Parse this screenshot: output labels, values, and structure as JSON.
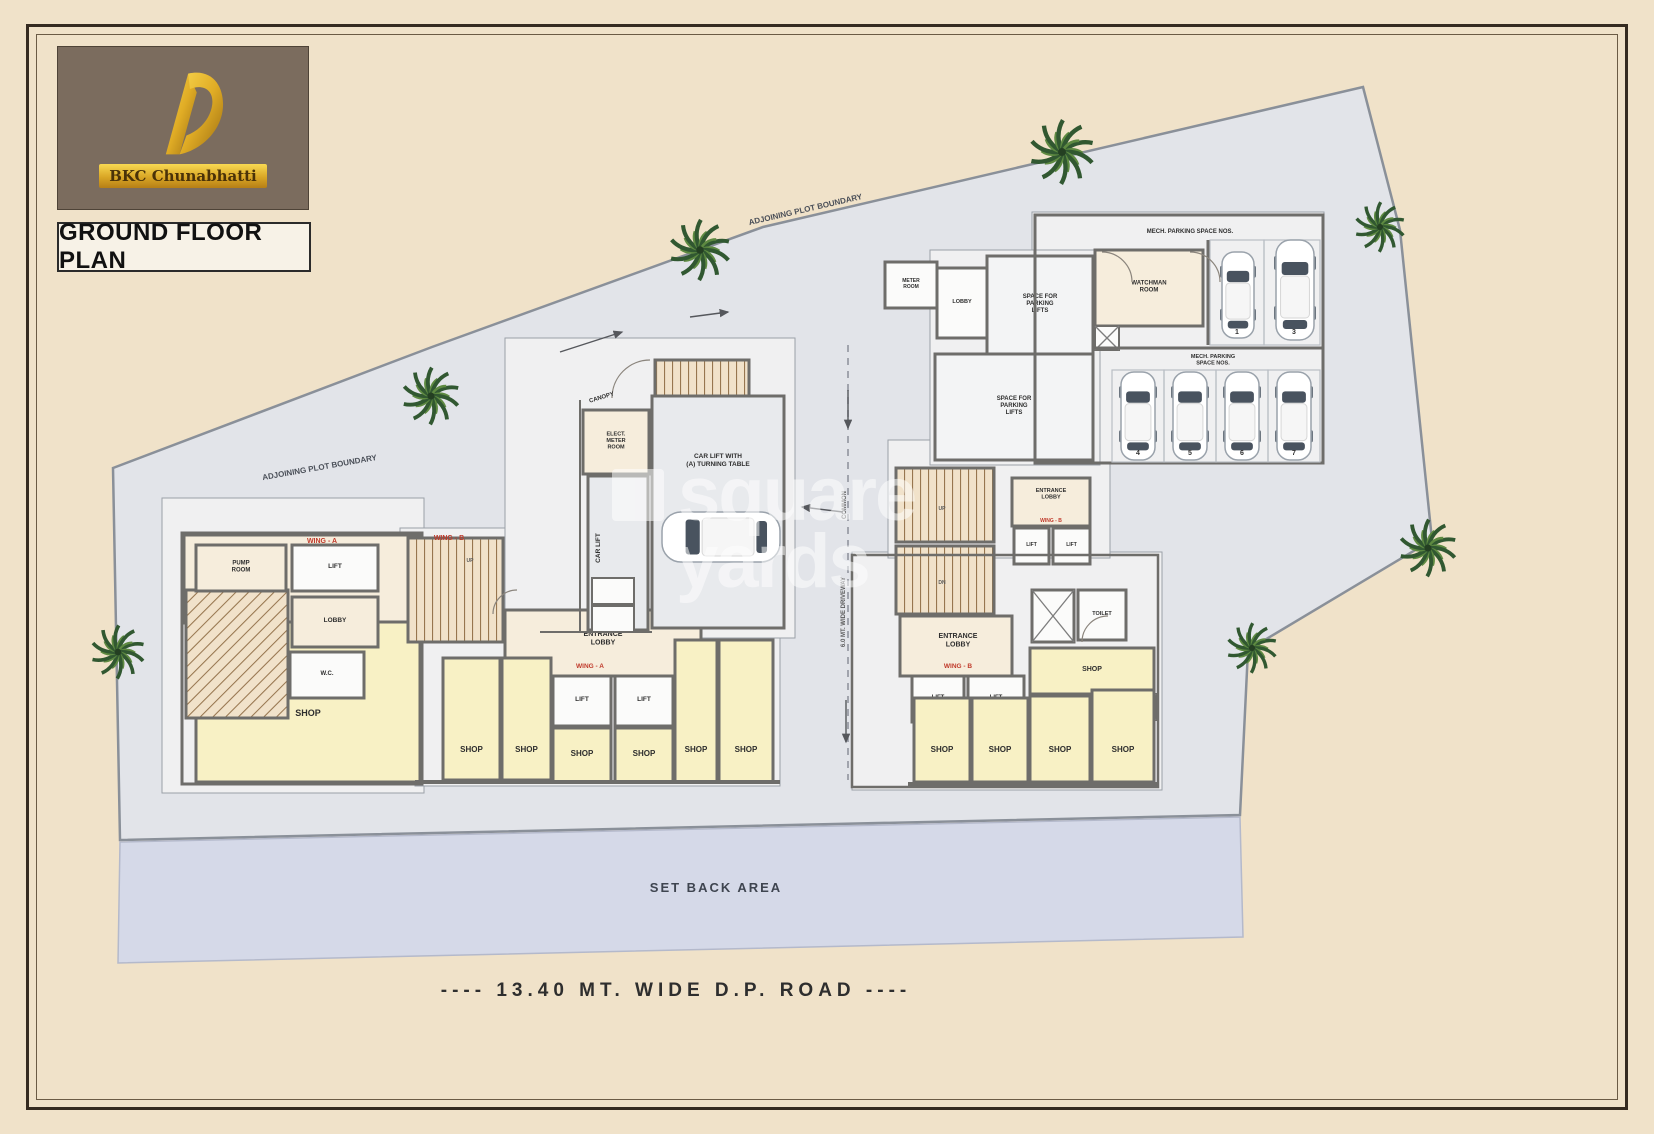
{
  "branding": {
    "logo_text": "BKC Chunabhatti",
    "title": "GROUND FLOOR PLAN"
  },
  "watermark": {
    "line1": "square",
    "line2": "yards"
  },
  "colors": {
    "page": "#f0e2c9",
    "plot": "#e2e4e9",
    "plotline": "#8a9099",
    "setback": "#d5d9e8",
    "setline": "#b4b9cb",
    "wall": "#6e6d6a",
    "cream": "#f6eddc",
    "white": "#fbfbfa",
    "yellow": "#f8f1c5",
    "gray": "#e8eaed",
    "slab": "#f0f0f1",
    "slabw": "#f3f4f5",
    "stair": "#f1e2ca",
    "stairline": "#97764f",
    "red": "#c03a2b",
    "ink": "#2e2e2e",
    "mut": "#5a5a5a",
    "mut2": "#4a4f58",
    "set": "#3f4550",
    "bay": "#b9bdc4",
    "carline": "#9aa2ab",
    "dark": "#49535f",
    "green1": "#315831",
    "green2": "#5e8a41"
  },
  "plan": {
    "plot_points": "113,468 432,347 763,227 1363,87 1400,230 1432,540 1248,650 1240,815 120,840",
    "setback_points": "120,842 1240,817 1243,937 118,963",
    "slabs": [
      {
        "id": "apron-left-wing",
        "x": 162,
        "y": 498,
        "w": 262,
        "h": 295
      },
      {
        "id": "apron-center-stair",
        "x": 400,
        "y": 528,
        "w": 110,
        "h": 120
      },
      {
        "id": "apron-shops-row",
        "x": 415,
        "y": 628,
        "w": 365,
        "h": 158
      },
      {
        "id": "apron-core",
        "x": 505,
        "y": 338,
        "w": 290,
        "h": 300
      },
      {
        "id": "apron-right-wing",
        "x": 852,
        "y": 552,
        "w": 310,
        "h": 238
      },
      {
        "id": "apron-right-wing-upper",
        "x": 888,
        "y": 440,
        "w": 222,
        "h": 118
      },
      {
        "id": "apron-parking",
        "x": 1032,
        "y": 212,
        "w": 292,
        "h": 252
      },
      {
        "id": "apron-parking-lifts",
        "x": 930,
        "y": 250,
        "w": 170,
        "h": 215
      }
    ],
    "rooms": [
      {
        "id": "left-wing-base",
        "x": 184,
        "y": 535,
        "w": 236,
        "h": 88,
        "f": "cream"
      },
      {
        "id": "left-wing-shop",
        "x": 196,
        "y": 622,
        "w": 224,
        "h": 160,
        "f": "yellow",
        "label": [
          "SHOP"
        ],
        "fs": 9,
        "ly": 716
      },
      {
        "id": "left-wing-winding-stair",
        "x": 186,
        "y": 590,
        "w": 102,
        "h": 128,
        "p": "d"
      },
      {
        "id": "left-wing-pump-room",
        "x": 196,
        "y": 545,
        "w": 90,
        "h": 46,
        "f": "cream",
        "label": [
          "PUMP",
          "ROOM"
        ],
        "fs": 6
      },
      {
        "id": "left-wing-lift",
        "x": 292,
        "y": 545,
        "w": 86,
        "h": 46,
        "f": "white",
        "label": [
          "LIFT"
        ],
        "fs": 6.5
      },
      {
        "id": "left-wing-lobby",
        "x": 292,
        "y": 597,
        "w": 86,
        "h": 50,
        "f": "cream",
        "label": [
          "LOBBY"
        ],
        "fs": 6.5
      },
      {
        "id": "left-wing-wc",
        "x": 290,
        "y": 652,
        "w": 74,
        "h": 46,
        "f": "white",
        "label": [
          "W.C."
        ],
        "fs": 6
      },
      {
        "id": "left-wing-outline",
        "x": 182,
        "y": 533,
        "w": 240,
        "h": 251,
        "f": "none",
        "sw": 3
      },
      {
        "id": "center-stair",
        "x": 408,
        "y": 538,
        "w": 95,
        "h": 104,
        "p": "v"
      },
      {
        "id": "center-entrance-lobby",
        "x": 505,
        "y": 610,
        "w": 196,
        "h": 66,
        "f": "cream",
        "label": [
          "ENTRANCE",
          "LOBBY"
        ],
        "fs": 7,
        "ly": 636
      },
      {
        "id": "center-lift-1",
        "x": 553,
        "y": 676,
        "w": 58,
        "h": 50,
        "f": "white",
        "label": [
          "LIFT"
        ],
        "fs": 6.5
      },
      {
        "id": "center-lift-2",
        "x": 615,
        "y": 676,
        "w": 58,
        "h": 50,
        "f": "white",
        "label": [
          "LIFT"
        ],
        "fs": 6.5
      },
      {
        "id": "shop-1",
        "x": 443,
        "y": 658,
        "w": 57,
        "h": 122,
        "f": "yellow",
        "label": [
          "SHOP"
        ],
        "fs": 8,
        "ly": 752
      },
      {
        "id": "shop-2",
        "x": 502,
        "y": 658,
        "w": 49,
        "h": 122,
        "f": "yellow",
        "label": [
          "SHOP"
        ],
        "fs": 8,
        "ly": 752
      },
      {
        "id": "shop-3",
        "x": 553,
        "y": 728,
        "w": 58,
        "h": 54,
        "f": "yellow",
        "label": [
          "SHOP"
        ],
        "fs": 8,
        "ly": 756
      },
      {
        "id": "shop-4",
        "x": 615,
        "y": 728,
        "w": 58,
        "h": 54,
        "f": "yellow",
        "label": [
          "SHOP"
        ],
        "fs": 8,
        "ly": 756
      },
      {
        "id": "shop-5",
        "x": 675,
        "y": 640,
        "w": 42,
        "h": 142,
        "f": "yellow",
        "label": [
          "SHOP"
        ],
        "fs": 8,
        "ly": 752
      },
      {
        "id": "shop-6",
        "x": 719,
        "y": 640,
        "w": 54,
        "h": 142,
        "f": "yellow",
        "label": [
          "SHOP"
        ],
        "fs": 8,
        "ly": 752
      },
      {
        "id": "core-meter-room",
        "x": 583,
        "y": 410,
        "w": 66,
        "h": 64,
        "f": "cream",
        "label": [
          "ELECT.",
          "METER",
          "ROOM"
        ],
        "fs": 5.5
      },
      {
        "id": "core-stair",
        "x": 655,
        "y": 360,
        "w": 94,
        "h": 38,
        "p": "v"
      },
      {
        "id": "core-car-lift-shaft",
        "x": 588,
        "y": 476,
        "w": 60,
        "h": 154,
        "f": "gray"
      },
      {
        "id": "core-box-1",
        "x": 592,
        "y": 578,
        "w": 42,
        "h": 26,
        "f": "white",
        "sw": 2
      },
      {
        "id": "core-box-2",
        "x": 592,
        "y": 606,
        "w": 42,
        "h": 26,
        "f": "white",
        "sw": 2
      },
      {
        "id": "core-turntable-room",
        "x": 652,
        "y": 396,
        "w": 132,
        "h": 232,
        "f": "gray",
        "label": [
          "CAR LIFT WITH",
          "(A) TURNING TABLE"
        ],
        "fs": 6.5,
        "ly": 458
      },
      {
        "id": "right-wing-stair-1",
        "x": 896,
        "y": 468,
        "w": 98,
        "h": 74,
        "p": "v"
      },
      {
        "id": "right-wing-stair-2",
        "x": 896,
        "y": 546,
        "w": 98,
        "h": 68,
        "p": "v"
      },
      {
        "id": "right-wing-entrance",
        "x": 1012,
        "y": 478,
        "w": 78,
        "h": 48,
        "f": "cream",
        "label": [
          "ENTRANCE",
          "LOBBY"
        ],
        "fs": 5.5,
        "ly": 492
      },
      {
        "id": "right-wing-lift-1",
        "x": 1014,
        "y": 528,
        "w": 35,
        "h": 36,
        "f": "white",
        "label": [
          "LIFT"
        ],
        "fs": 5
      },
      {
        "id": "right-wing-lift-2",
        "x": 1053,
        "y": 528,
        "w": 37,
        "h": 36,
        "f": "white",
        "label": [
          "LIFT"
        ],
        "fs": 5
      },
      {
        "id": "right-wing-lobby",
        "x": 900,
        "y": 616,
        "w": 112,
        "h": 60,
        "f": "cream"
      },
      {
        "id": "right-wing-lift-3",
        "x": 912,
        "y": 676,
        "w": 52,
        "h": 46,
        "f": "white",
        "label": [
          "LIFT"
        ],
        "fs": 6
      },
      {
        "id": "right-wing-lift-4",
        "x": 968,
        "y": 676,
        "w": 56,
        "h": 46,
        "f": "white",
        "label": [
          "LIFT"
        ],
        "fs": 6
      },
      {
        "id": "right-wing-shaft",
        "x": 1032,
        "y": 590,
        "w": 42,
        "h": 52,
        "f": "white",
        "X": true
      },
      {
        "id": "right-wing-toilet",
        "x": 1078,
        "y": 590,
        "w": 48,
        "h": 50,
        "f": "white",
        "label": [
          "TOILET"
        ],
        "fs": 5.5
      },
      {
        "id": "right-wing-shop-top",
        "x": 1030,
        "y": 648,
        "w": 124,
        "h": 46,
        "f": "yellow",
        "label": [
          "SHOP"
        ],
        "fs": 7
      },
      {
        "id": "right-wing-shaft-2",
        "x": 1134,
        "y": 694,
        "w": 22,
        "h": 26,
        "f": "white",
        "X": true,
        "sw": 2
      },
      {
        "id": "shop-7",
        "x": 914,
        "y": 698,
        "w": 56,
        "h": 84,
        "f": "yellow",
        "label": [
          "SHOP"
        ],
        "fs": 8,
        "ly": 752
      },
      {
        "id": "shop-8",
        "x": 972,
        "y": 698,
        "w": 56,
        "h": 84,
        "f": "yellow",
        "label": [
          "SHOP"
        ],
        "fs": 8,
        "ly": 752
      },
      {
        "id": "shop-9",
        "x": 1030,
        "y": 696,
        "w": 60,
        "h": 86,
        "f": "yellow",
        "label": [
          "SHOP"
        ],
        "fs": 8,
        "ly": 752
      },
      {
        "id": "shop-10",
        "x": 1092,
        "y": 690,
        "w": 62,
        "h": 92,
        "f": "yellow",
        "label": [
          "SHOP"
        ],
        "fs": 8,
        "ly": 752
      },
      {
        "id": "right-wing-outline",
        "x": 852,
        "y": 555,
        "w": 306,
        "h": 232,
        "f": "none",
        "sw": 2.5
      },
      {
        "id": "parking-watchman-room",
        "x": 1095,
        "y": 250,
        "w": 108,
        "h": 76,
        "f": "cream",
        "label": [
          "WATCHMAN",
          "ROOM"
        ],
        "fs": 6
      },
      {
        "id": "parking-shaft",
        "x": 1095,
        "y": 326,
        "w": 24,
        "h": 24,
        "f": "white",
        "X": true,
        "sw": 2
      },
      {
        "id": "parking-lobby",
        "x": 937,
        "y": 268,
        "w": 50,
        "h": 70,
        "f": "white",
        "label": [
          "LOBBY"
        ],
        "fs": 5.5
      },
      {
        "id": "parking-lift-space-1",
        "x": 987,
        "y": 256,
        "w": 106,
        "h": 98,
        "f": "slabw",
        "label": [
          "SPACE FOR",
          "PARKING",
          "LIFTS"
        ],
        "fs": 6
      },
      {
        "id": "parking-lift-space-2",
        "x": 935,
        "y": 354,
        "w": 158,
        "h": 106,
        "f": "slabw",
        "label": [
          "SPACE FOR",
          "PARKING",
          "LIFTS"
        ],
        "fs": 6
      },
      {
        "id": "parking-meter-room",
        "x": 885,
        "y": 262,
        "w": 52,
        "h": 46,
        "f": "white",
        "label": [
          "METER",
          "ROOM"
        ],
        "fs": 5
      },
      {
        "id": "parking-outline",
        "x": 1035,
        "y": 215,
        "w": 288,
        "h": 248,
        "f": "none",
        "sw": 3
      }
    ],
    "walls": [
      {
        "id": "parking-divider-h",
        "x1": 1095,
        "y1": 348,
        "x2": 1323,
        "y2": 348,
        "w": 3
      },
      {
        "id": "parking-divider-v",
        "x1": 1208,
        "y1": 240,
        "x2": 1208,
        "y2": 345,
        "w": 3
      },
      {
        "id": "shopfront-left",
        "x1": 415,
        "y1": 782,
        "x2": 780,
        "y2": 782,
        "w": 4
      },
      {
        "id": "shopfront-right",
        "x1": 908,
        "y1": 784,
        "x2": 1158,
        "y2": 784,
        "w": 4
      },
      {
        "id": "core-outline-left",
        "x1": 580,
        "y1": 400,
        "x2": 580,
        "y2": 632,
        "w": 2
      },
      {
        "id": "core-outline-bottom",
        "x1": 540,
        "y1": 632,
        "x2": 652,
        "y2": 632,
        "w": 2
      }
    ],
    "bays": [
      {
        "x": 1210,
        "y": 240,
        "w": 54,
        "h": 105
      },
      {
        "x": 1264,
        "y": 240,
        "w": 56,
        "h": 105
      },
      {
        "x": 1112,
        "y": 370,
        "w": 52,
        "h": 92
      },
      {
        "x": 1164,
        "y": 370,
        "w": 52,
        "h": 92
      },
      {
        "x": 1216,
        "y": 370,
        "w": 52,
        "h": 92
      },
      {
        "x": 1268,
        "y": 370,
        "w": 52,
        "h": 92
      }
    ],
    "cars": [
      {
        "x": 1222,
        "y": 252,
        "l": 86,
        "w": 32
      },
      {
        "x": 1276,
        "y": 240,
        "l": 100,
        "w": 38
      },
      {
        "x": 1121,
        "y": 372,
        "l": 88,
        "w": 34
      },
      {
        "x": 1173,
        "y": 372,
        "l": 88,
        "w": 34
      },
      {
        "x": 1225,
        "y": 372,
        "l": 88,
        "w": 34
      },
      {
        "x": 1277,
        "y": 372,
        "l": 88,
        "w": 34
      },
      {
        "x": 662,
        "y": 512,
        "l": 118,
        "w": 50,
        "h": true
      }
    ],
    "centerline": {
      "x": 848,
      "y1": 345,
      "y2": 780
    },
    "arrows": [
      [
        560,
        352,
        622,
        332
      ],
      [
        690,
        317,
        728,
        312
      ],
      [
        848,
        390,
        848,
        428
      ],
      [
        843,
        512,
        802,
        507
      ],
      [
        846,
        700,
        846,
        742
      ]
    ],
    "arcs": [
      {
        "d": "M612,398 A38,38 0 0 1 650,360"
      },
      {
        "d": "M1102,252 A30,30 0 0 1 1132,282"
      },
      {
        "d": "M1190,252 A30,30 0 0 1 1220,282"
      },
      {
        "d": "M1082,642 A26,26 0 0 1 1108,616"
      },
      {
        "d": "M493,614 A24,24 0 0 1 517,590"
      }
    ],
    "trees": [
      {
        "x": 700,
        "y": 250,
        "s": 1.7
      },
      {
        "x": 1062,
        "y": 152,
        "s": 1.8
      },
      {
        "x": 1380,
        "y": 227,
        "s": 1.4
      },
      {
        "x": 1428,
        "y": 548,
        "s": 1.6
      },
      {
        "x": 1252,
        "y": 648,
        "s": 1.4
      },
      {
        "x": 431,
        "y": 396,
        "s": 1.6
      },
      {
        "x": 118,
        "y": 652,
        "s": 1.5
      }
    ],
    "labels": [
      {
        "t": [
          "WING - A"
        ],
        "x": 322,
        "y": 543,
        "fs": 7,
        "c": "red"
      },
      {
        "t": [
          "WING - B"
        ],
        "x": 449,
        "y": 540,
        "fs": 7,
        "c": "red"
      },
      {
        "t": [
          "WING - A"
        ],
        "x": 590,
        "y": 668,
        "fs": 6.5,
        "c": "red"
      },
      {
        "t": [
          "ENTRANCE",
          "LOBBY"
        ],
        "x": 958,
        "y": 638,
        "fs": 7
      },
      {
        "t": [
          "WING - B"
        ],
        "x": 958,
        "y": 668,
        "fs": 6.5,
        "c": "red"
      },
      {
        "t": [
          "WING - B"
        ],
        "x": 1051,
        "y": 522,
        "fs": 5,
        "c": "red"
      },
      {
        "t": [
          "CANOPY"
        ],
        "x": 602,
        "y": 399,
        "fs": 6,
        "rot": -17
      },
      {
        "t": [
          "CAR LIFT"
        ],
        "x": 600,
        "y": 548,
        "fs": 6.5,
        "rot": -90
      },
      {
        "t": [
          "MECH. PARKING SPACE NOS."
        ],
        "x": 1190,
        "y": 233,
        "fs": 6
      },
      {
        "t": [
          "MECH. PARKING",
          "SPACE NOS."
        ],
        "x": 1213,
        "y": 358,
        "fs": 5.5
      },
      {
        "t": [
          "1"
        ],
        "x": 1237,
        "y": 334,
        "fs": 7
      },
      {
        "t": [
          "3"
        ],
        "x": 1294,
        "y": 334,
        "fs": 7
      },
      {
        "t": [
          "4"
        ],
        "x": 1138,
        "y": 455,
        "fs": 7
      },
      {
        "t": [
          "5"
        ],
        "x": 1190,
        "y": 455,
        "fs": 7
      },
      {
        "t": [
          "6"
        ],
        "x": 1242,
        "y": 455,
        "fs": 7
      },
      {
        "t": [
          "7"
        ],
        "x": 1294,
        "y": 455,
        "fs": 7
      },
      {
        "t": [
          "COMMON"
        ],
        "x": 846,
        "y": 505,
        "fs": 6,
        "rot": -90,
        "c": "mut"
      },
      {
        "t": [
          "6.0 MT. WIDE DRIVEWAY"
        ],
        "x": 845,
        "y": 612,
        "fs": 6,
        "rot": -90,
        "c": "mut"
      },
      {
        "t": [
          "UP"
        ],
        "x": 470,
        "y": 562,
        "fs": 5,
        "c": "mut"
      },
      {
        "t": [
          "UP"
        ],
        "x": 942,
        "y": 510,
        "fs": 5,
        "c": "mut"
      },
      {
        "t": [
          "DN"
        ],
        "x": 942,
        "y": 584,
        "fs": 5,
        "c": "mut"
      },
      {
        "t": [
          "SET BACK AREA"
        ],
        "x": 716,
        "y": 892,
        "fs": 13,
        "ls": 2,
        "c": "set"
      },
      {
        "t": [
          "ADJOINING PLOT BOUNDARY"
        ],
        "x": 320,
        "y": 470,
        "fs": 8,
        "rot": -10,
        "c": "mut2"
      },
      {
        "t": [
          "ADJOINING PLOT BOUNDARY"
        ],
        "x": 806,
        "y": 212,
        "fs": 8,
        "rot": -13,
        "c": "mut2"
      },
      {
        "t": [
          "---- 13.40 MT. WIDE D.P. ROAD ----"
        ],
        "x": 676,
        "y": 996,
        "fs": 19,
        "ls": 5,
        "bold": true
      }
    ]
  }
}
